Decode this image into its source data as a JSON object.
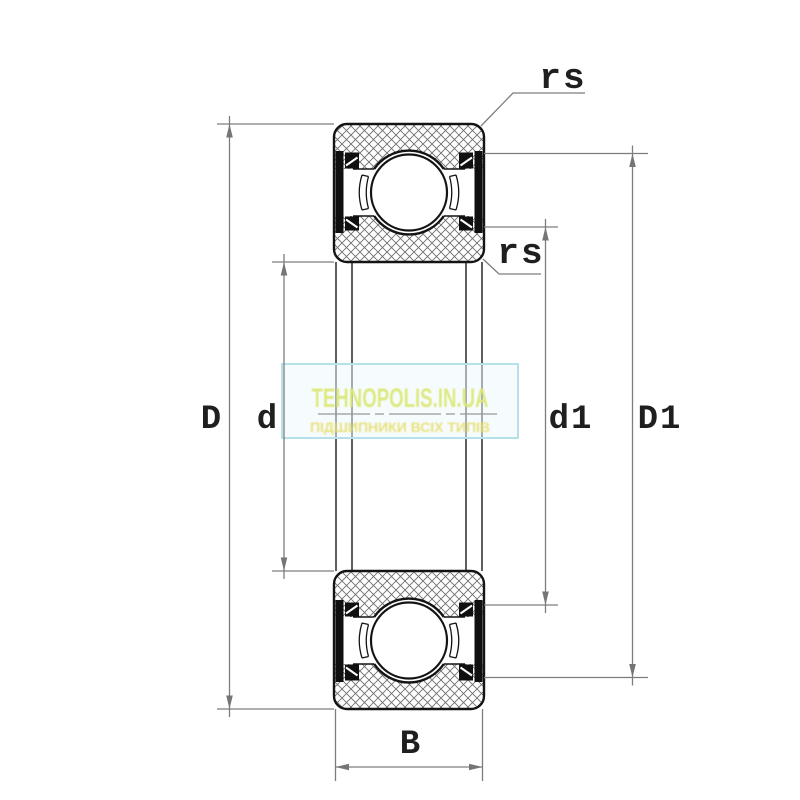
{
  "diagram": {
    "kind": "ball-bearing-cross-section-drawing",
    "labels": {
      "outer_diameter": "D",
      "bore_diameter": "d",
      "inner_shoulder_diameter": "d1",
      "outer_shoulder_diameter": "D1",
      "width": "B",
      "fillet_top": "rs",
      "fillet_mid": "rs"
    }
  },
  "watermark": {
    "title": "TEHNOPOLIS.IN.UA",
    "tagline": "ПІДШИПНИКИ ВСІХ ТИПІВ"
  },
  "colors": {
    "background": "#ffffff",
    "outline": "#141414",
    "seal": "#101010",
    "hatch": "#6e6e6e",
    "dimension_line": "#7d7d7d",
    "arrow": "#757575",
    "connector": "#4d4d4d",
    "centerline": "#999999",
    "watermark_border": "#b5e2ea",
    "watermark_title": "#dce878",
    "watermark_tagline": "#e7dc66"
  }
}
